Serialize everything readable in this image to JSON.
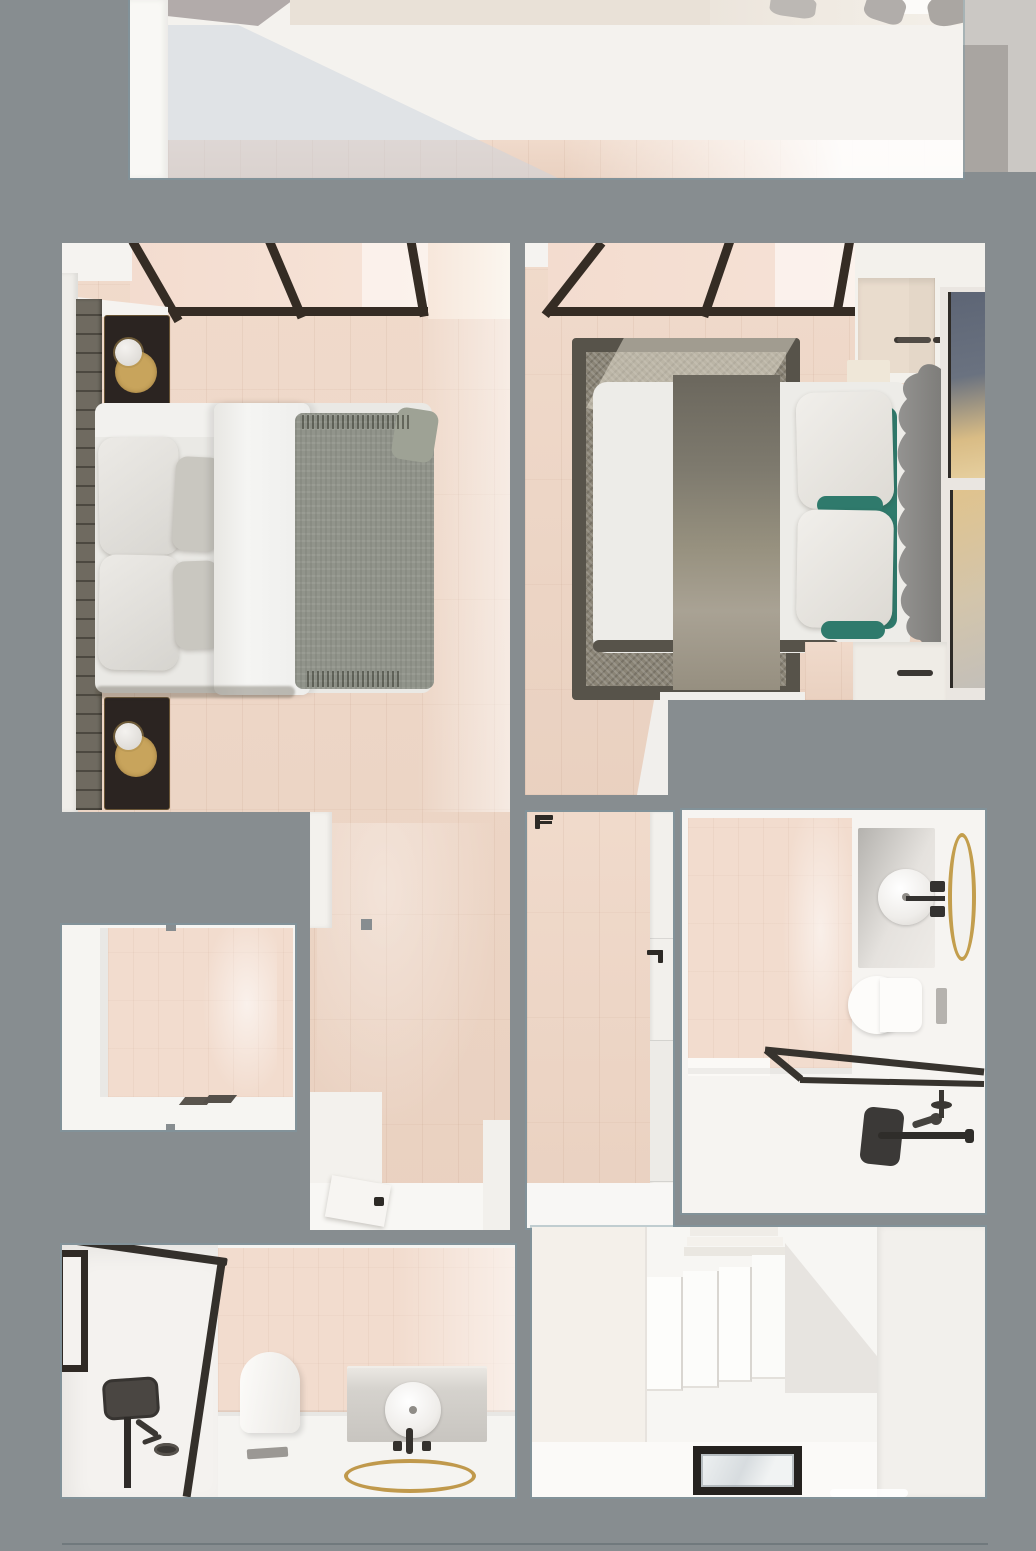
{
  "scene": {
    "description": "top-down 3d architectural render of a two-bedroom apartment floor plan",
    "view": "bird's-eye plan render, no visible text",
    "rooms": [
      {
        "id": "living-room-partial",
        "furniture": [
          "white-wall-band",
          "wood-floor-strip",
          "side-table",
          "gray-planter-shapes",
          "diagonal-light-shadow"
        ]
      },
      {
        "id": "bedroom-left-wing",
        "furniture": [
          "floor-to-ceiling-window-frames",
          "slatted-accent-wall",
          "nightstand-top",
          "nightstand-bottom",
          "brass-tray",
          "sphere-table-lamp",
          "double-bed",
          "white-pillows",
          "gray-pillows",
          "white-duvet-roll",
          "gray-throw-blanket",
          "hallway-floor",
          "open-door",
          "door-handle"
        ]
      },
      {
        "id": "wardrobe-room",
        "furniture": [
          "wardrobe-front-panel",
          "door-handles"
        ]
      },
      {
        "id": "bedroom-right-wing",
        "furniture": [
          "skylight-window-frames",
          "area-rug",
          "double-bed",
          "textured-bed-runner",
          "white-pillows",
          "teal-accent-pillows",
          "wavy-upholstered-headboard",
          "wall-art-frame-top",
          "wall-art-frame-bottom",
          "towel-rail",
          "bedside-cabinet",
          "wood-corridor"
        ]
      },
      {
        "id": "hallway-middle",
        "furniture": [
          "wood-floor",
          "door-handle-top",
          "door-handle-right",
          "white-door-wall"
        ]
      },
      {
        "id": "bathroom-right",
        "furniture": [
          "pink-tile-wall",
          "vanity-counter",
          "round-vessel-sink",
          "black-faucet",
          "oval-brass-mirror",
          "wall-hung-toilet",
          "flush-plate",
          "shower-screen-frame",
          "black-shower-column",
          "grab-bar",
          "hand-shower",
          "shower-valve"
        ]
      },
      {
        "id": "bathroom-bottom",
        "furniture": [
          "window",
          "glass-shower-screen-frame",
          "black-shower-panel",
          "shower-pole",
          "hose-fitting",
          "toilet",
          "floor-drain",
          "vanity-cabinet",
          "round-vessel-sink",
          "black-taps",
          "round-brass-mirror-ring"
        ]
      },
      {
        "id": "staircase-room",
        "furniture": [
          "stair-slabs",
          "upper-steps",
          "diagonal-stair-shadow",
          "glass-floor-skylight"
        ]
      }
    ]
  },
  "palette": {
    "bg": "#878d90",
    "white_wall": "#f3f1ed",
    "white_bright": "#fbfaf8",
    "wood": "#eed5c4",
    "pane": "#f4ddd0",
    "frame": "#352c24",
    "slat": "#6f6a60",
    "nightstand": "#2b2421",
    "brass": "#c8a45c",
    "lamp": "#ece9e5",
    "duvet": "#f2f1ee",
    "blanket": "#91948b",
    "pillow": "#e4e3df",
    "pillow_gray": "#c9c7c0",
    "rug_border": "#57534a",
    "rug_field": "#8a8476",
    "runner": "#7e7a6e",
    "teal": "#2f7a6c",
    "headboard": "#8b8a88",
    "art_navy": "#5d6575",
    "art_gold": "#e0c38d",
    "tile": "#f2dcce",
    "vanity": "#c9c6c2",
    "fixture": "#37332e",
    "shadow_blue": "#ccd3dd",
    "ext_light": "#cbc8c4",
    "ext_mid": "#a9a5a1",
    "glass": "#dfe4e7",
    "border_line": "#7d99a3"
  }
}
